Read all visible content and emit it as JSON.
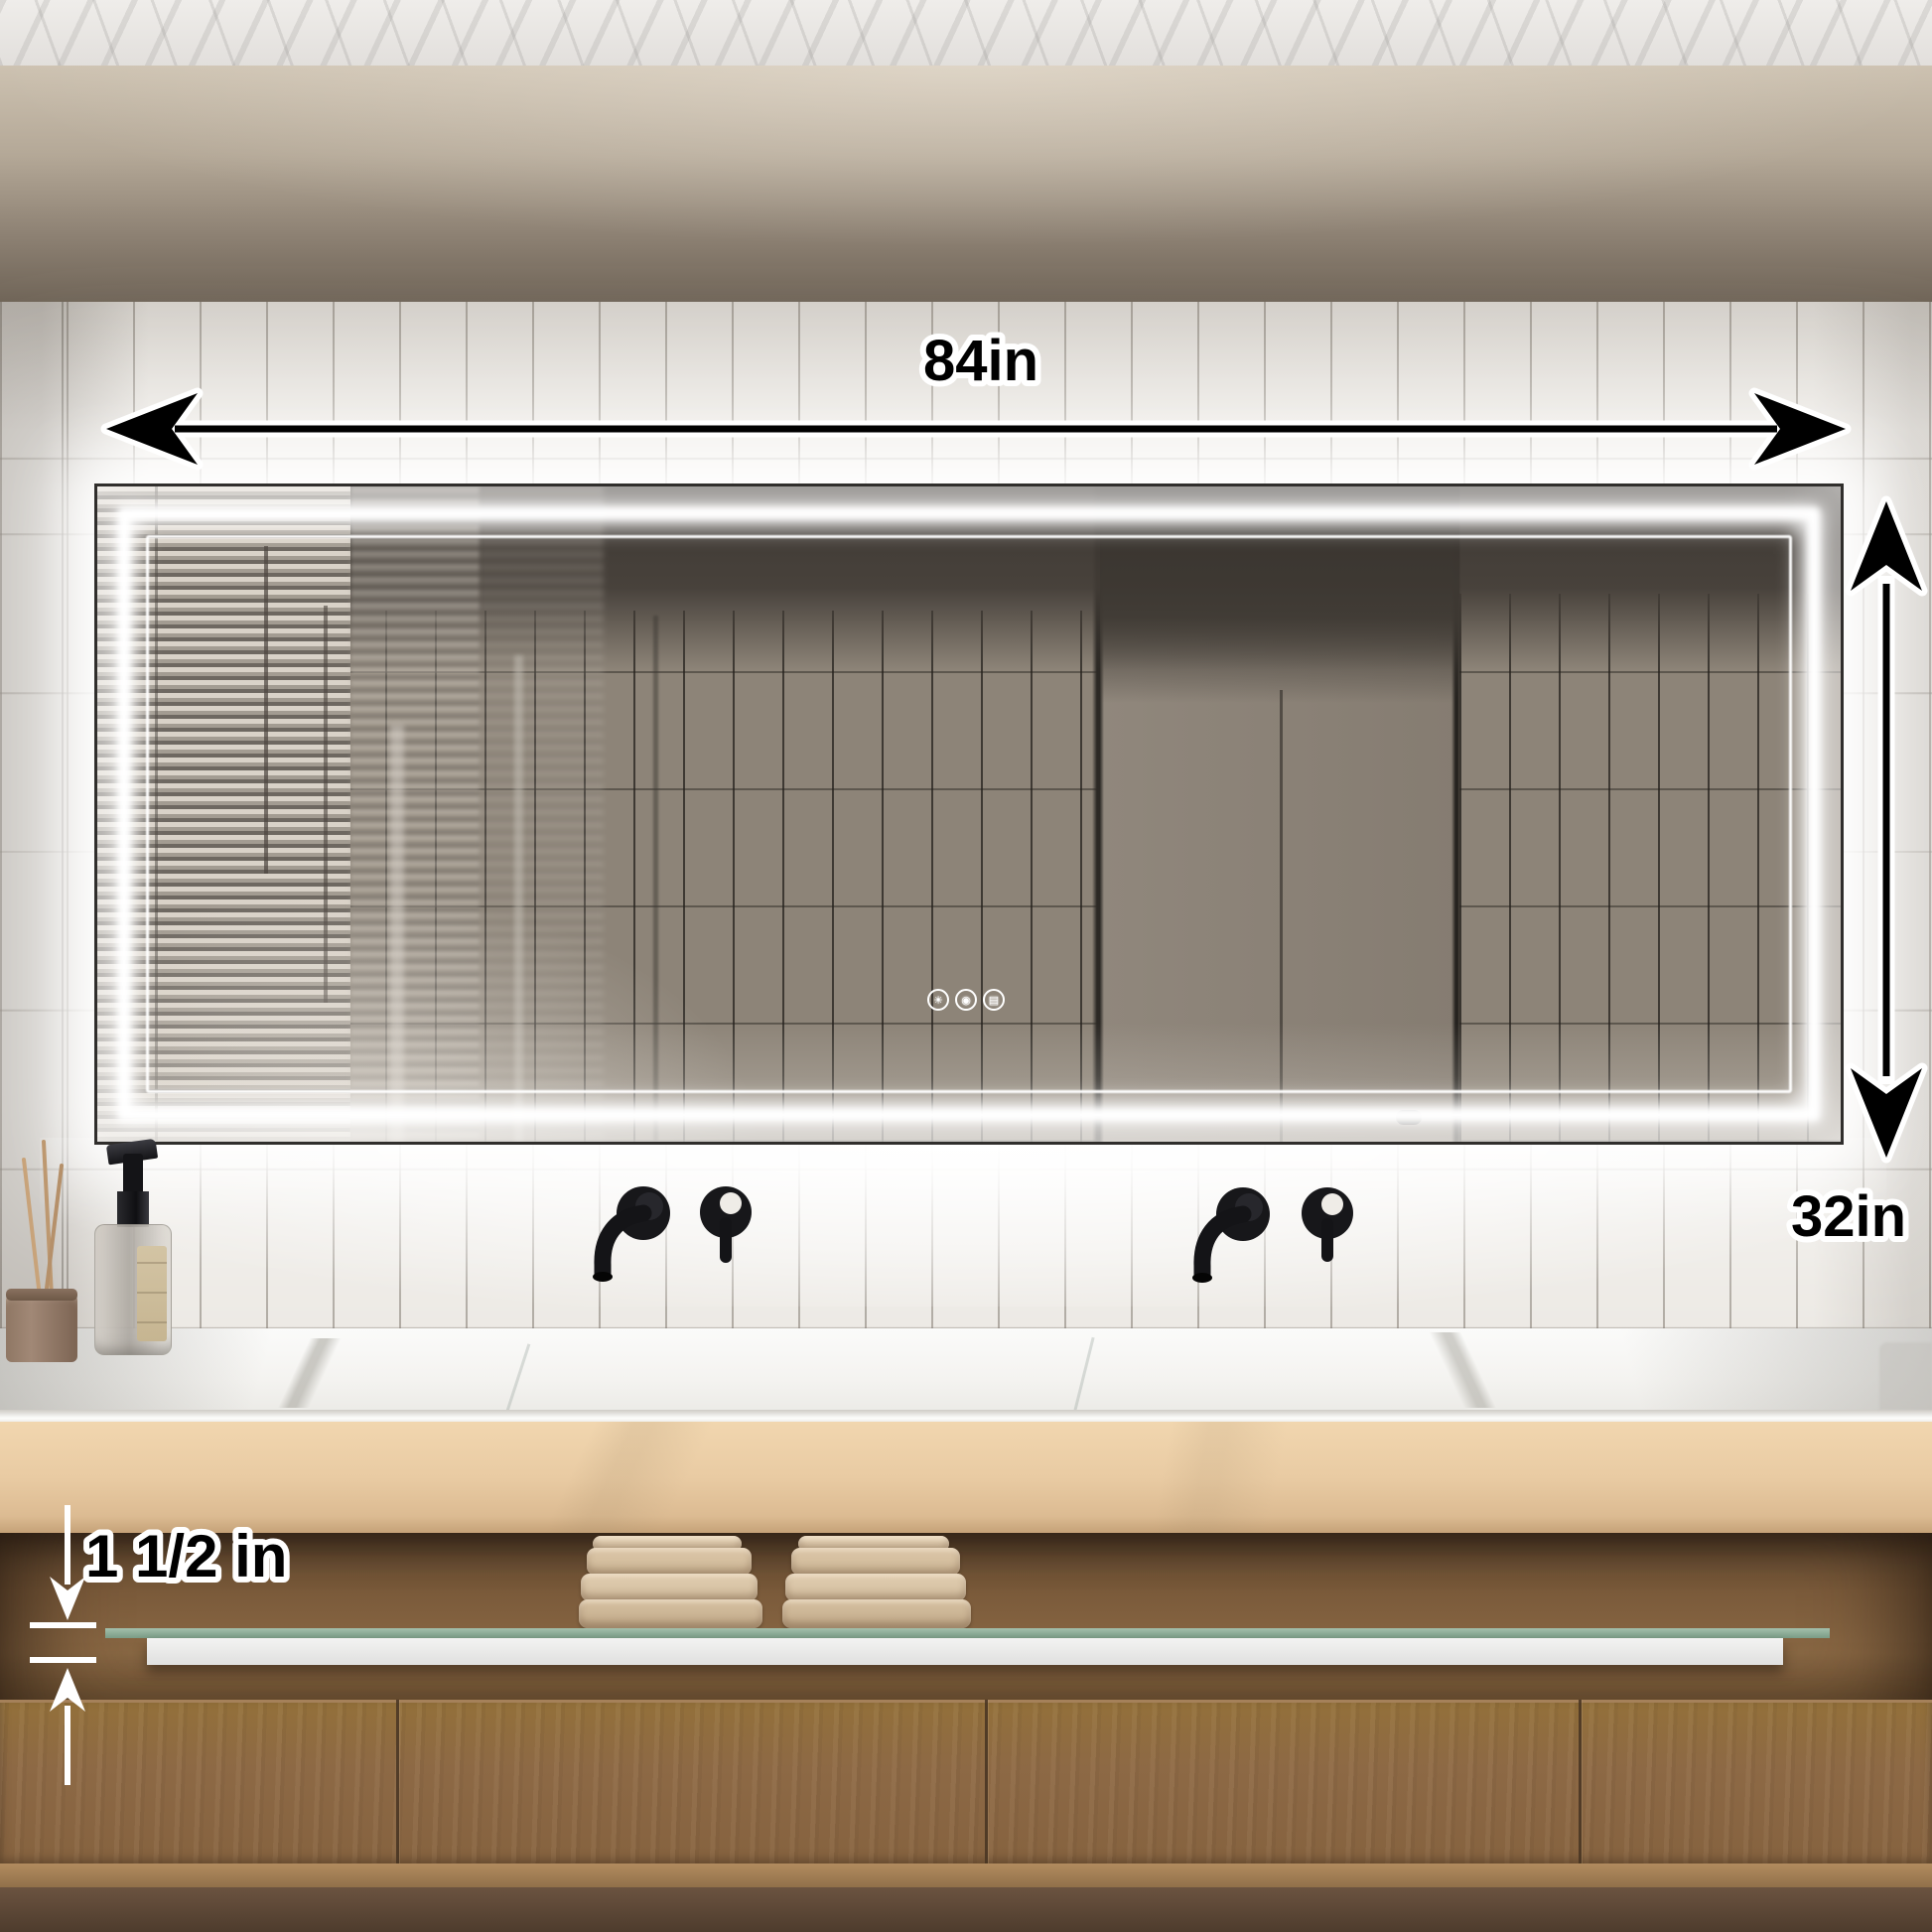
{
  "annotations": {
    "width_label": "84in",
    "height_label": "32in",
    "shelf_label": "1 1/2 in"
  },
  "mirror_controls": {
    "buttons": [
      {
        "name": "brightness-button",
        "icon": "brightness-icon",
        "glyph": "☀"
      },
      {
        "name": "light-toggle-button",
        "icon": "light-icon",
        "glyph": "◉"
      },
      {
        "name": "defog-button",
        "icon": "defog-icon",
        "glyph": "▤"
      }
    ]
  },
  "palette": {
    "led_white": "#ffffff",
    "annotation_text": "#000000",
    "annotation_outline": "#ffffff",
    "small_arrow_white": "#ffffff",
    "glass_shelf_green": "#7fa08c",
    "shelf_front_white": "#ececec",
    "counter_marble": "#f4f3f0",
    "fascia_beige": "#e9cba3",
    "wood_drawer": "#8d6945",
    "niche_brown": "#7a5a3a",
    "wall_tile": "#edeae5",
    "reflection_tile": "#8d8478",
    "faucet_black": "#17171a",
    "towel_beige": "#d8c3a6"
  }
}
